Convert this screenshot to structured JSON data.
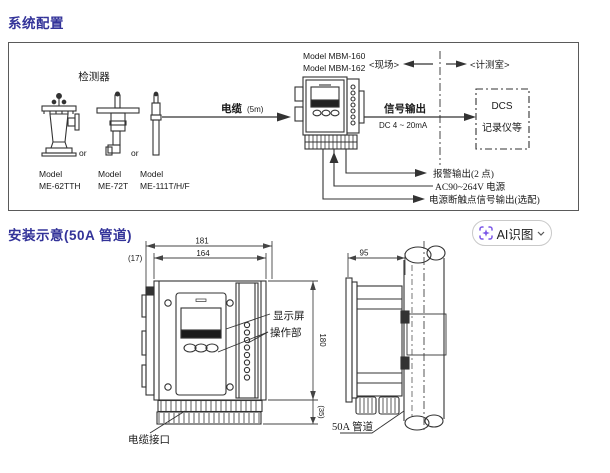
{
  "titles": {
    "system": "系统配置",
    "install": "安装示意(50A 管道)"
  },
  "ai_button": {
    "label": "AI识图",
    "icon": "ai-scan-icon",
    "icon_color": "#7b57e8"
  },
  "system_diagram": {
    "detector_label": "检测器",
    "or1": "or",
    "or2": "or",
    "model1_line1": "Model",
    "model1_line2": "ME-62TTH",
    "model2_line1": "Model",
    "model2_line2": "ME-72T",
    "model3_line1": "Model",
    "model3_line2": "ME-111T/H/F",
    "cable_label": "电缆",
    "cable_length": "(5m)",
    "controller_model1": "Model MBM-160",
    "controller_model2": "Model MBM-162",
    "field_label": "<现场>",
    "room_label": "<计测室>",
    "signal_label": "信号输出",
    "signal_range": "DC 4 ~ 20mA",
    "dcs_line1": "DCS",
    "dcs_line2": "记录仪等",
    "out_alarm": "报警输出(2 点)",
    "out_power": "AC90~264V 电源",
    "out_contact": "电源断触点信号输出(选配)"
  },
  "install_diagram": {
    "dim_width_outer": "181",
    "dim_width_inner": "164",
    "dim_offset": "(17)",
    "dim_height": "180",
    "dim_bottom": "(35)",
    "dim_depth": "95",
    "display_label": "显示屏",
    "operation_label": "操作部",
    "cable_port_label": "电缆接口",
    "pipe_label": "50A 管道"
  }
}
